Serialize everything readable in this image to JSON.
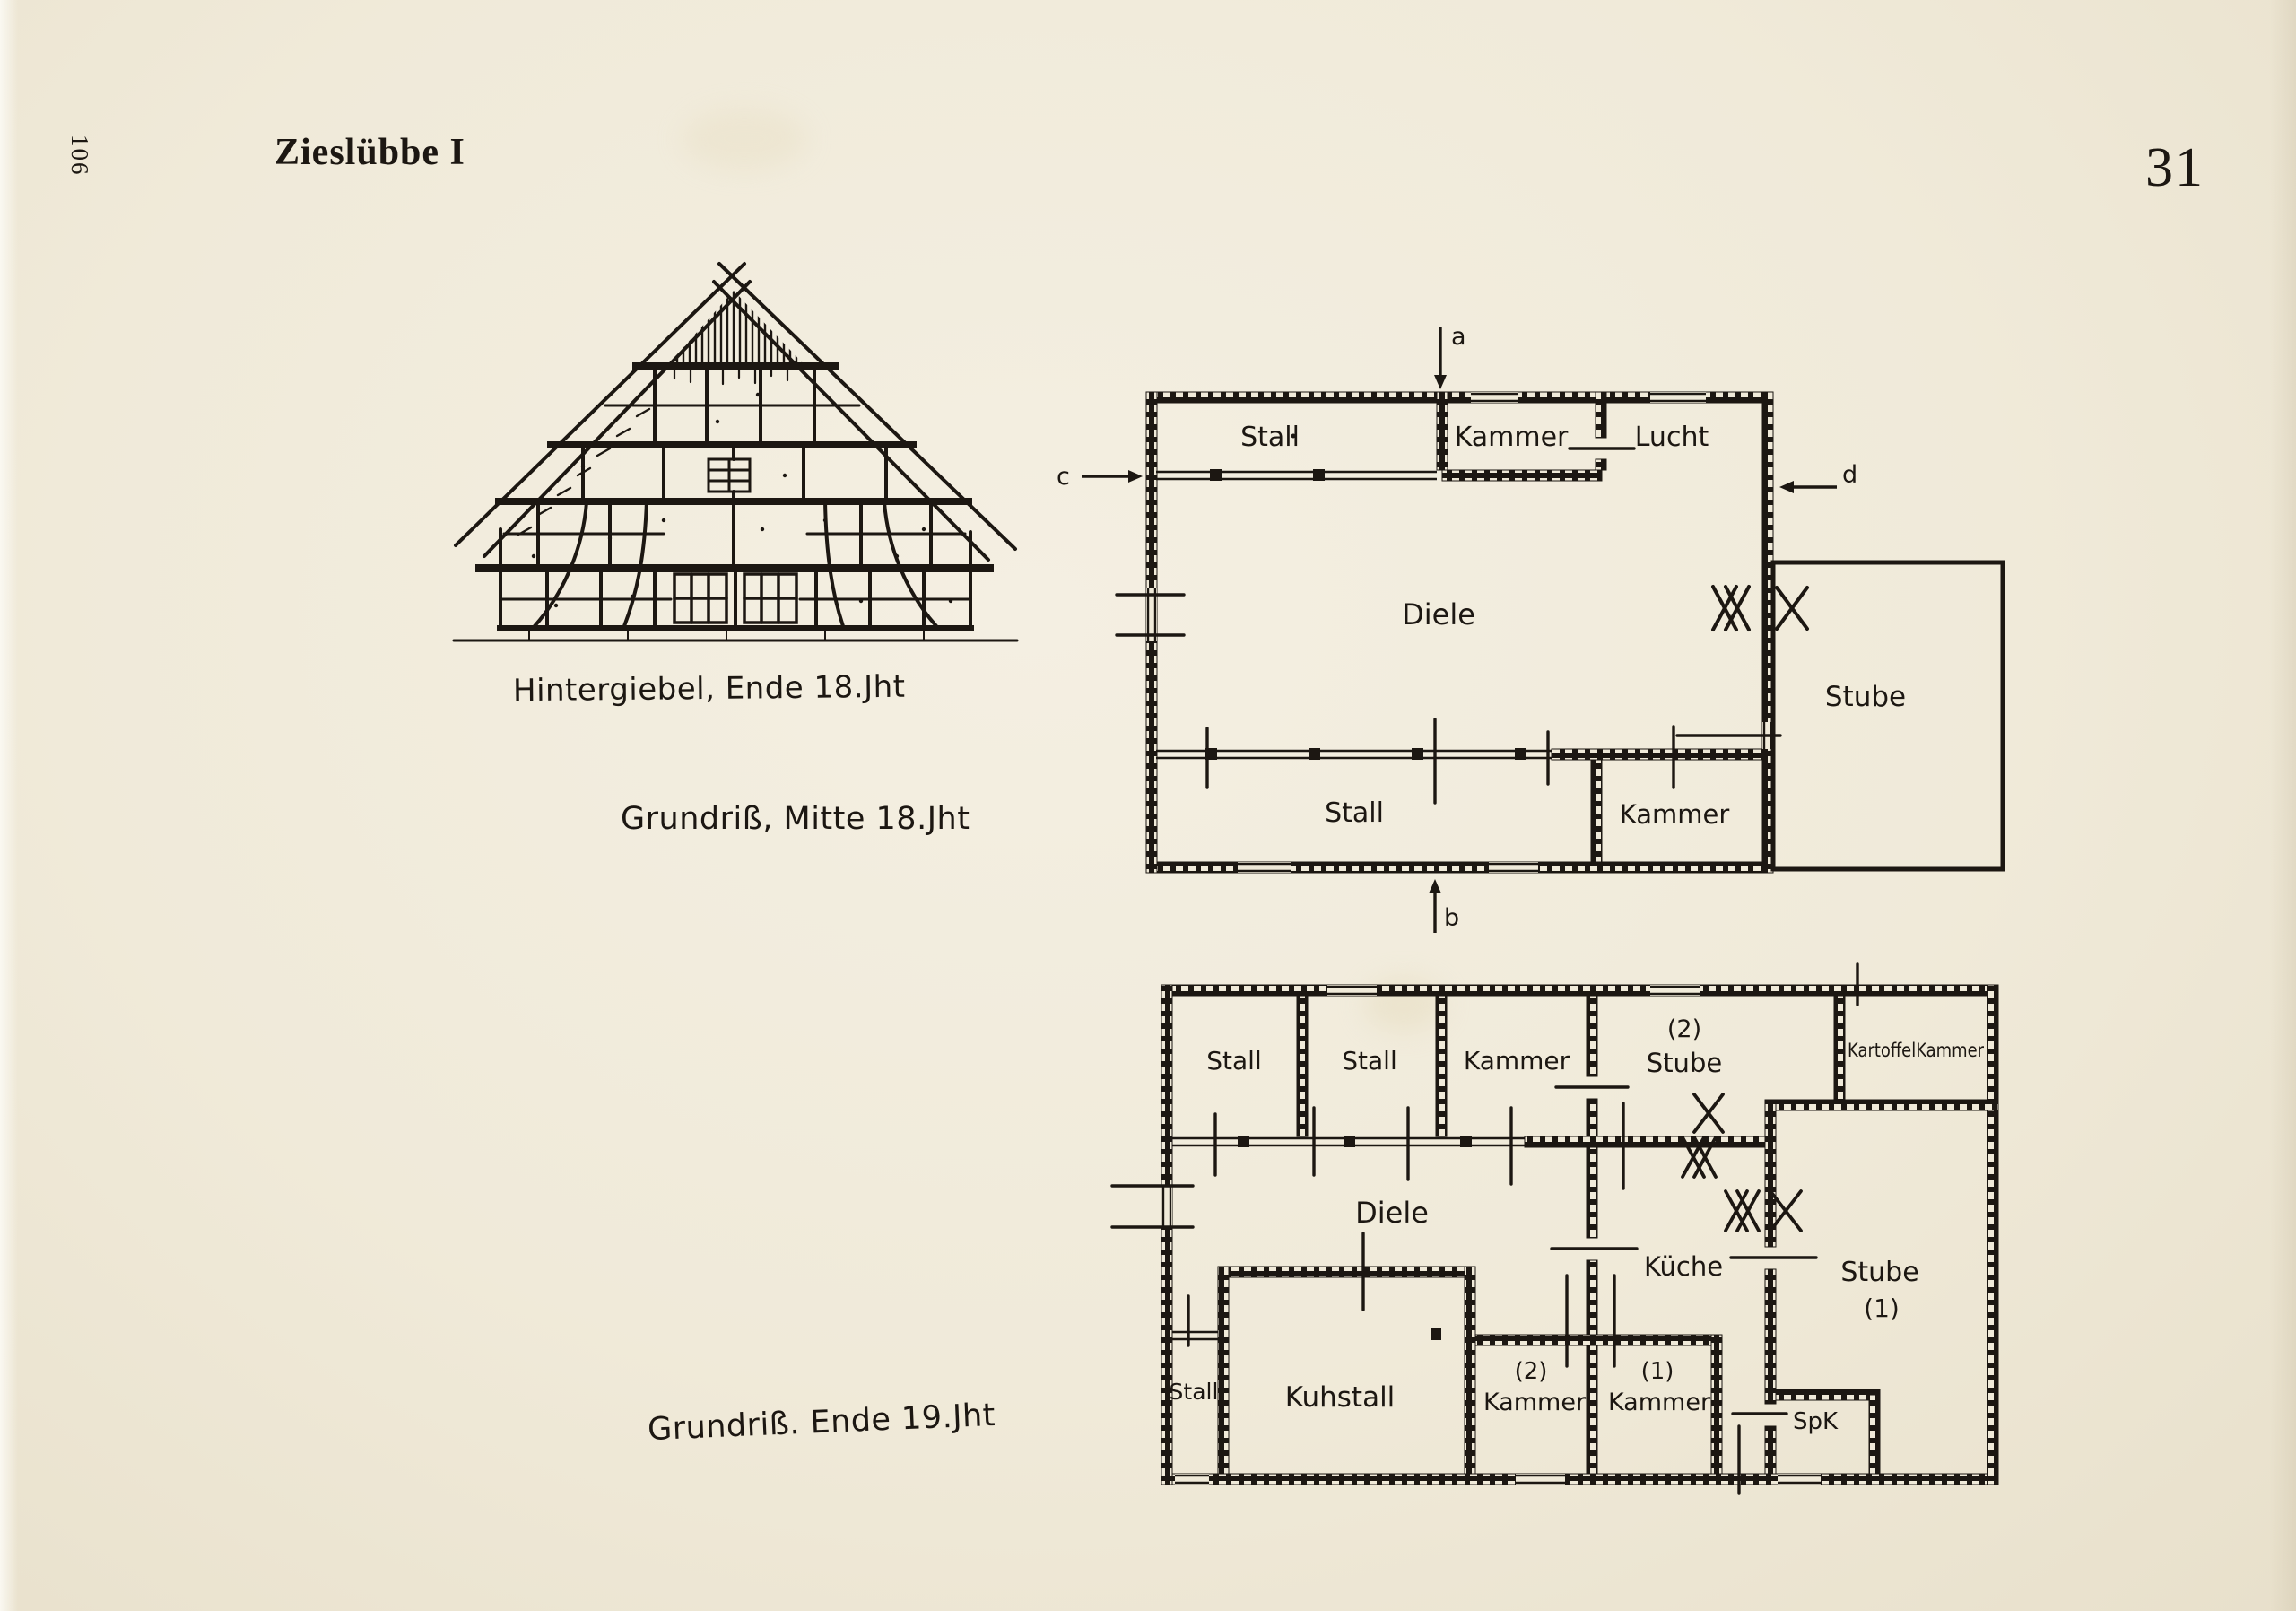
{
  "page": {
    "margin_page_number": "106",
    "heading": "Zieslübbe I",
    "page_number": "31"
  },
  "gable": {
    "caption": "Hintergiebel, Ende 18.Jht"
  },
  "plan_mid18": {
    "caption": "Grundriß, Mitte 18.Jht",
    "rooms": {
      "stall_top": "Stall",
      "kammer_top": "Kammer",
      "lucht": "Lucht",
      "diele": "Diele",
      "stube": "Stube",
      "stall_bottom": "Stall",
      "kammer_bottom": "Kammer"
    },
    "section_marks": {
      "a": "a",
      "b": "b",
      "c": "c",
      "d": "d"
    }
  },
  "plan_end19": {
    "caption": "Grundriß. Ende 19.Jht",
    "rooms": {
      "stall_1": "Stall",
      "stall_2": "Stall",
      "kammer_top": "Kammer",
      "stube_2_no": "(2)",
      "stube_2": "Stube",
      "kartoffelkammer": "KartoffelKammer",
      "diele": "Diele",
      "kueche": "Küche",
      "stube_1": "Stube",
      "stube_1_no": "(1)",
      "stall_left": "Stall",
      "kuhstall": "Kuhstall",
      "kammer_2_no": "(2)",
      "kammer_2": "Kammer",
      "kammer_1_no": "(1)",
      "kammer_1": "Kammer",
      "spk": "SpK"
    }
  }
}
